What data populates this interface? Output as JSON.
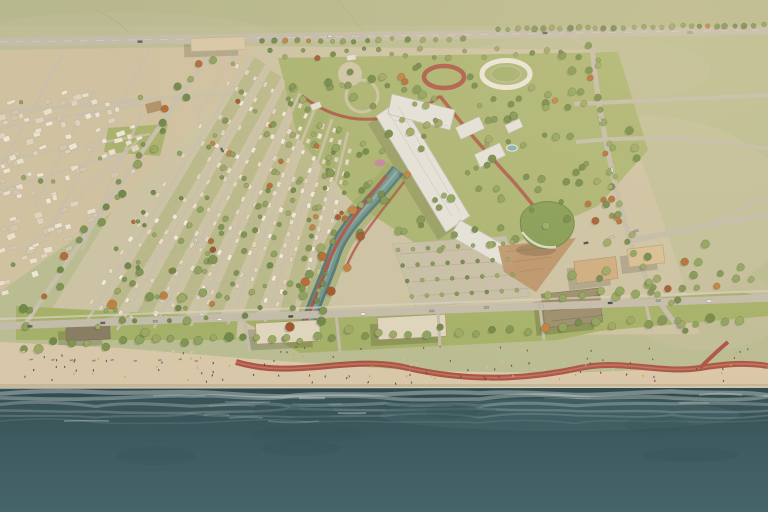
{
  "scene": {
    "type": "architectural-aerial-rendering",
    "description": "Aerial masterplan rendering of a coastal development: villa district with tree-lined streets, central park with canal, oval pavilion and white canopy market street, beachfront lawns with pavilions, winding red cycle promenade, sandy beach and dark teal sea",
    "regions": {
      "field": "Open grassland",
      "highway": "Highway",
      "existing_city": "Existing neighborhood",
      "villa_district": "Villa district",
      "central_park": "Central park",
      "canal": "Water canal",
      "canopy": "Canopy market street",
      "stadium": "Oval pavilion",
      "parking": "Parking grove",
      "promenade": "Beach promenade with red cycle path",
      "beach": "Sandy beach",
      "sea": "Sea"
    }
  },
  "palette": {
    "field_green": "#b8bb90",
    "field_shade": "#c8c1a0",
    "terrain_beige": "#cfc0a1",
    "terrain_dev": "#cbc2a4",
    "park_green": "#a7b36e",
    "lawn_green": "#a2af65",
    "road_light": "#d8d2c2",
    "road_mid": "#c7bfab",
    "asphalt": "#c2bbaa",
    "path_red": "#a84f41",
    "path_red_light": "#cf8a6a",
    "canal_edge": "#4f7674",
    "canal_water": "#68938f",
    "canopy_white": "#e4e3de",
    "canopy_shade": "#bcbbb3",
    "stadium_rim": "#ece8dc",
    "green_roof": "#7f9950",
    "plaza_terracotta": "#b98e63",
    "pool_blue": "#6fb0bf",
    "playground_pink": "#c47fa2",
    "roof_tan": "#cdab7e",
    "roof_tan2": "#d8bd92",
    "roof_dark": "#847a5f",
    "roof_light": "#ded5bd",
    "wood": "#a8906a",
    "sand": "#d9c7a9",
    "sand_wet": "#b5a890",
    "ocean_near": "#2d4a50",
    "ocean_mid": "#35555c",
    "ocean_deep": "#3c5e65",
    "tree_green_1": "#7b924e",
    "tree_green_2": "#89a159",
    "tree_green_3": "#6c8644",
    "tree_olive": "#98a65f",
    "tree_autumn_1": "#b4672f",
    "tree_autumn_2": "#c07c3a",
    "tree_autumn_3": "#a1522a",
    "villas": [
      "#f0e9d8",
      "#e7ddc9",
      "#ddd3bf",
      "#e2d3ba"
    ],
    "city_blocks": [
      "#e9e0cd",
      "#ded3bd",
      "#d2c6ae",
      "#efe7d6"
    ],
    "cars": [
      "#f4f4f2",
      "#dfe0dd",
      "#9aa0a2",
      "#5a6064",
      "#c9cbc8",
      "#3f4446"
    ],
    "people": [
      "#3c4043",
      "#6e4638",
      "#c3c7cc",
      "#8c3434",
      "#33506e",
      "#caa13f"
    ]
  }
}
